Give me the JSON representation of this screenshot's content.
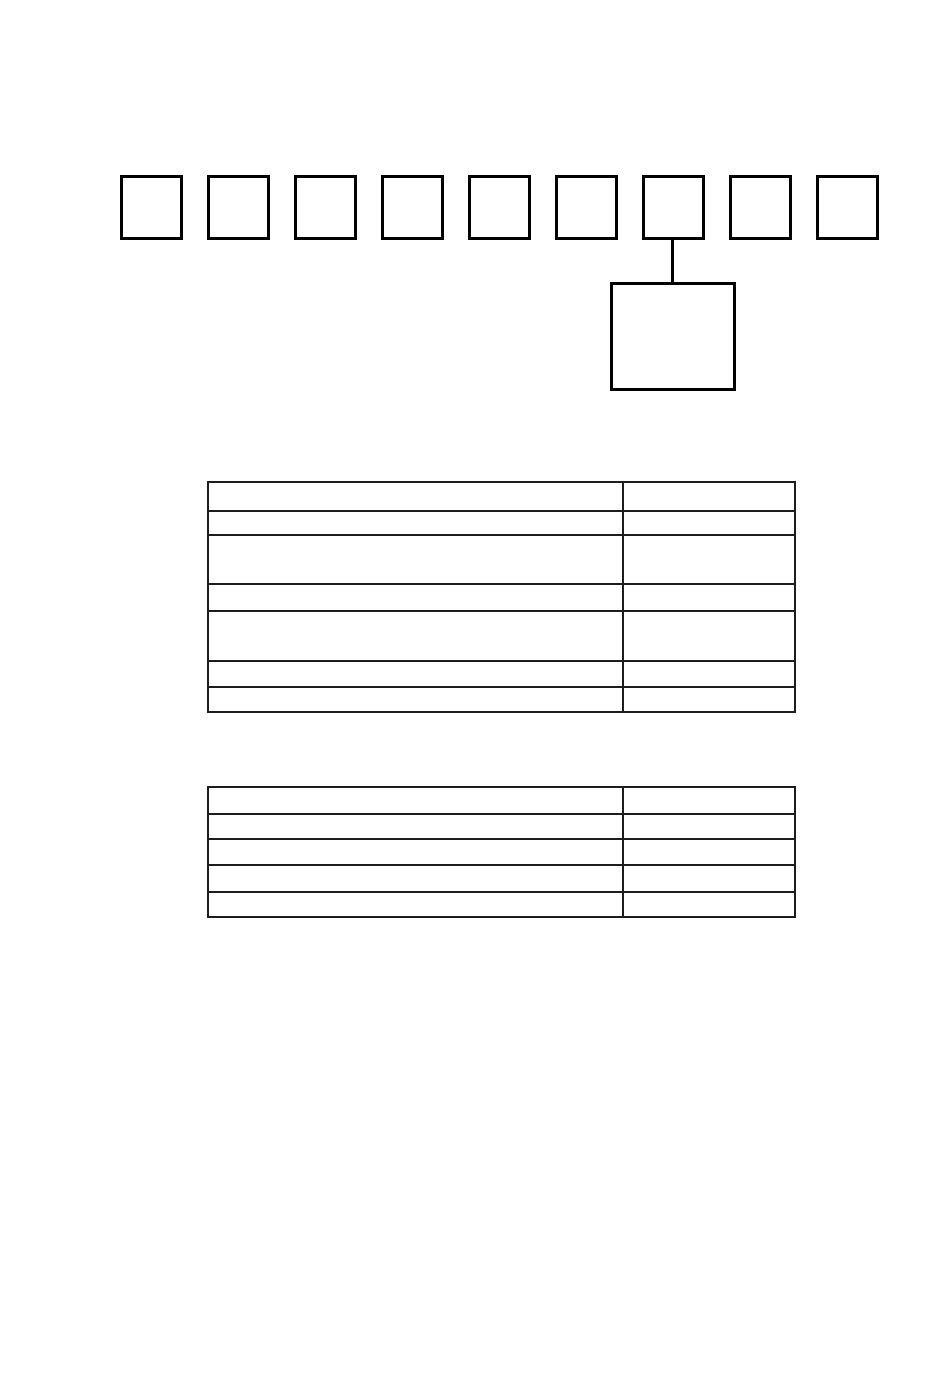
{
  "page": {
    "background": "#ffffff",
    "width_px": 950,
    "height_px": 1392
  },
  "colors": {
    "diagram_border": "#000000",
    "table_border": "#1d1d1d"
  },
  "code_diagram": {
    "boxes": [
      {
        "label": ""
      },
      {
        "label": ""
      },
      {
        "label": ""
      },
      {
        "label": ""
      },
      {
        "label": ""
      },
      {
        "label": ""
      },
      {
        "label": ""
      },
      {
        "label": ""
      },
      {
        "label": ""
      }
    ],
    "connector_from_box_number": 7,
    "callout_box": {
      "label": ""
    }
  },
  "upper_table": {
    "rows": [
      {
        "label": "",
        "value": ""
      },
      {
        "label": "",
        "value": ""
      },
      {
        "label": "",
        "value": ""
      },
      {
        "label": "",
        "value": ""
      },
      {
        "label": "",
        "value": ""
      },
      {
        "label": "",
        "value": ""
      },
      {
        "label": "",
        "value": ""
      }
    ]
  },
  "lower_table": {
    "rows": [
      {
        "label": "",
        "value": ""
      },
      {
        "label": "",
        "value": ""
      },
      {
        "label": "",
        "value": ""
      },
      {
        "label": "",
        "value": ""
      },
      {
        "label": "",
        "value": ""
      }
    ]
  }
}
